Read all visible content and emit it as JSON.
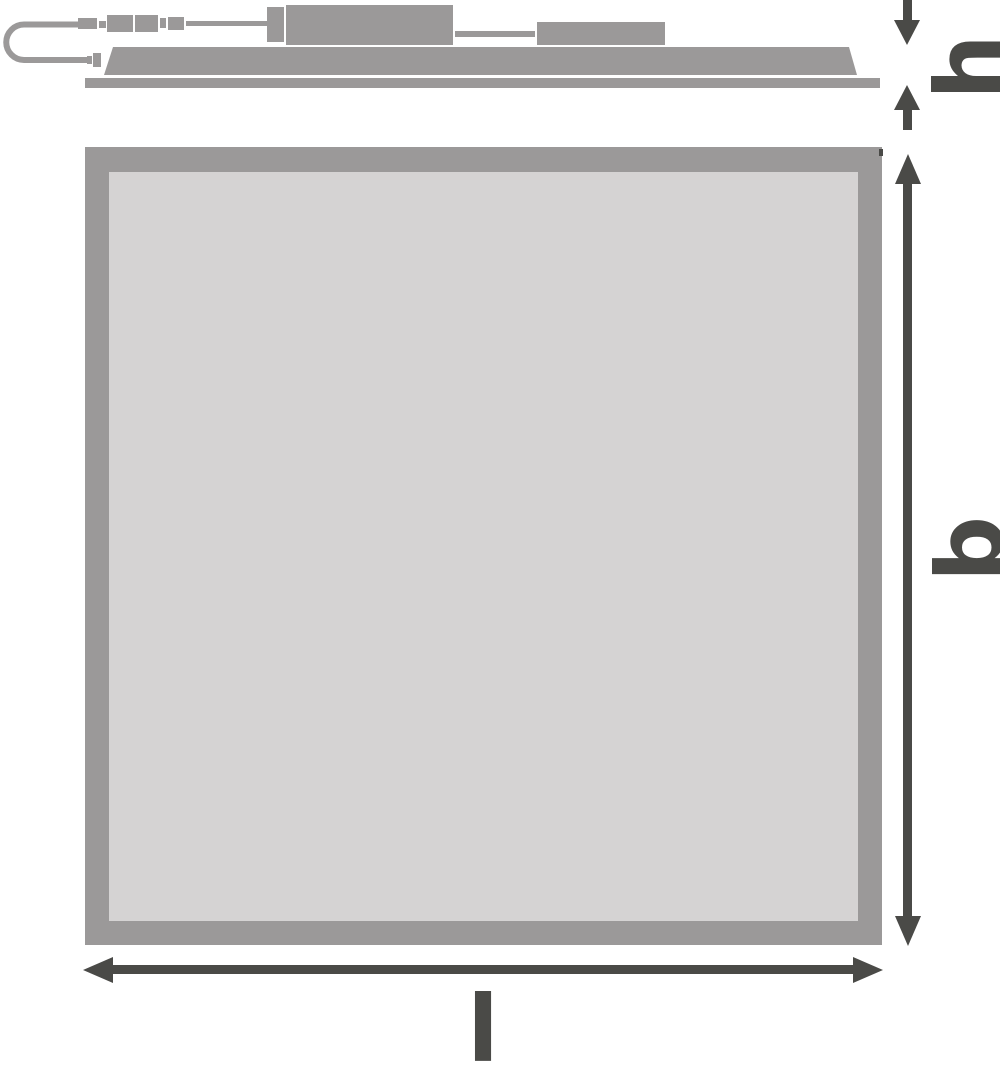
{
  "drawing": {
    "kind": "technical-dimension-drawing",
    "subject": "square LED panel luminaire with external driver (side view and front view)",
    "labels": {
      "height": "h",
      "width": "b",
      "length": "l"
    },
    "colors": {
      "part_gray": "#9B9999",
      "panel_face_gray": "#D5D3D3",
      "dimension_dark": "#4A4A47",
      "background": "#FFFFFF"
    }
  }
}
